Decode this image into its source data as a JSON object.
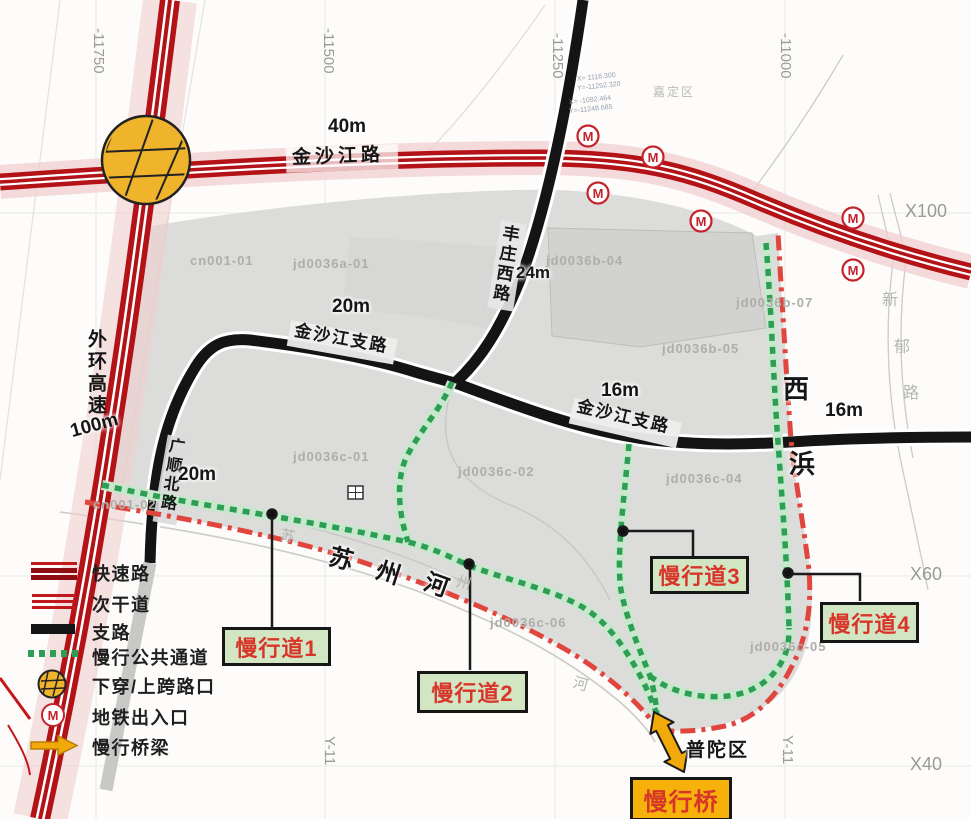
{
  "map": {
    "roads": {
      "jinshajiang": {
        "name": "金沙江路",
        "width": "40m"
      },
      "waihuan": {
        "name": "外环高速",
        "width": "100m"
      },
      "branch_west": {
        "name": "金沙江支路",
        "width": "20m"
      },
      "branch_east": {
        "name": "金沙江支路",
        "width": "16m"
      },
      "fengzhuang": {
        "name": "丰庄西路",
        "width": "24m"
      },
      "guangshun": {
        "name": "广顺北路",
        "width": "20m"
      },
      "xibang": {
        "char_top": "西",
        "char_bottom": "浜",
        "width": "16m"
      },
      "xinyu_chars": [
        "新",
        "郁",
        "路"
      ]
    },
    "river": {
      "chars": [
        "苏",
        "州",
        "河"
      ],
      "faint_chars": [
        "苏",
        "州",
        "河"
      ]
    },
    "districts": {
      "south": "普陀区",
      "north": "嘉定区"
    },
    "callouts": {
      "lane1": "慢行道1",
      "lane2": "慢行道2",
      "lane3": "慢行道3",
      "lane4": "慢行道4",
      "bridge": "慢行桥"
    },
    "parcels": [
      "cn001-01",
      "jd0036a-01",
      "jd0036b-04",
      "jd0036b-07",
      "jd0036b-05",
      "cn001-02",
      "jd0036c-01",
      "jd0036c-02",
      "jd0036c-04",
      "jd0036c-06",
      "jd0036c-05"
    ],
    "grid": {
      "x": [
        "X100",
        "X60",
        "X40"
      ],
      "y_top": [
        "-11750",
        "-11500",
        "-11250",
        "-11000"
      ],
      "y_bottom": [
        "Y-11",
        "Y-11"
      ]
    },
    "survey_notes": [
      "X= 1116.300",
      "Y=-11252.320",
      "X= -1092.464",
      "Y=-11248.685"
    ],
    "metro_letter": "M"
  },
  "legend": {
    "items": [
      "快速路",
      "次干道",
      "支路",
      "慢行公共通道",
      "下穿/上跨路口",
      "地铁出入口",
      "慢行桥梁"
    ]
  },
  "colors": {
    "expressway": "#c6151b",
    "expressway_dark": "#8f0d12",
    "branch_road": "#141414",
    "greenway": "#2f9e55",
    "boundary": "#e0463e",
    "callout_bg": "#d3e6c3",
    "bridge_bg": "#f6b10b",
    "callout_text": "#d8352a",
    "junction": "#f0b42c"
  }
}
